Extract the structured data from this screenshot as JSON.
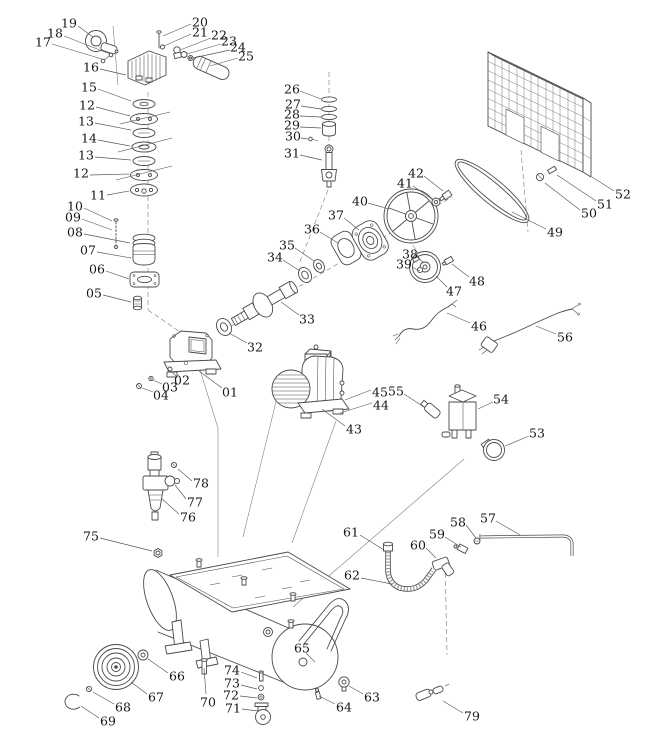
{
  "diagram": {
    "name": "air-compressor-exploded-parts-diagram",
    "background_color": "#ffffff",
    "line_color": "#4a4a4a",
    "label_color": "#161616",
    "part_labels": [
      {
        "text": "19",
        "x": 69,
        "y": 23,
        "line": [
          78,
          26,
          93,
          37
        ]
      },
      {
        "text": "18",
        "x": 55,
        "y": 33,
        "line": [
          64,
          36,
          110,
          54
        ]
      },
      {
        "text": "17",
        "x": 43,
        "y": 42,
        "line": [
          52,
          44,
          102,
          59
        ]
      },
      {
        "text": "16",
        "x": 91,
        "y": 67,
        "line": [
          100,
          69,
          126,
          75
        ]
      },
      {
        "text": "15",
        "x": 89,
        "y": 87,
        "line": [
          98,
          89,
          131,
          101
        ]
      },
      {
        "text": "12",
        "x": 87,
        "y": 105,
        "line": [
          96,
          107,
          130,
          116
        ]
      },
      {
        "text": "13",
        "x": 86,
        "y": 121,
        "line": [
          95,
          123,
          131,
          130
        ]
      },
      {
        "text": "14",
        "x": 89,
        "y": 138,
        "line": [
          98,
          140,
          130,
          146
        ]
      },
      {
        "text": "13",
        "x": 86,
        "y": 155,
        "line": [
          95,
          157,
          131,
          160
        ]
      },
      {
        "text": "12",
        "x": 81,
        "y": 173,
        "line": [
          90,
          175,
          129,
          174
        ]
      },
      {
        "text": "11",
        "x": 98,
        "y": 195,
        "line": [
          107,
          195,
          129,
          191
        ]
      },
      {
        "text": "10",
        "x": 75,
        "y": 206,
        "line": [
          84,
          208,
          112,
          221
        ]
      },
      {
        "text": "09",
        "x": 73,
        "y": 217,
        "line": [
          82,
          219,
          112,
          230
        ]
      },
      {
        "text": "08",
        "x": 75,
        "y": 232,
        "line": [
          84,
          234,
          130,
          243
        ]
      },
      {
        "text": "07",
        "x": 88,
        "y": 250,
        "line": [
          97,
          252,
          131,
          258
        ]
      },
      {
        "text": "06",
        "x": 97,
        "y": 269,
        "line": [
          106,
          271,
          129,
          279
        ]
      },
      {
        "text": "05",
        "x": 94,
        "y": 293,
        "line": [
          103,
          295,
          131,
          302
        ]
      },
      {
        "text": "20",
        "x": 200,
        "y": 22,
        "line": [
          191,
          24,
          163,
          36
        ]
      },
      {
        "text": "21",
        "x": 200,
        "y": 32,
        "line": [
          191,
          34,
          164,
          46
        ]
      },
      {
        "text": "22",
        "x": 219,
        "y": 35,
        "line": [
          211,
          38,
          180,
          50
        ]
      },
      {
        "text": "23",
        "x": 229,
        "y": 41,
        "line": [
          221,
          44,
          187,
          54
        ]
      },
      {
        "text": "24",
        "x": 238,
        "y": 47,
        "line": [
          230,
          50,
          193,
          58
        ]
      },
      {
        "text": "25",
        "x": 246,
        "y": 56,
        "line": [
          238,
          58,
          210,
          66
        ]
      },
      {
        "text": "26",
        "x": 292,
        "y": 89,
        "line": [
          300,
          91,
          321,
          99
        ]
      },
      {
        "text": "27",
        "x": 293,
        "y": 104,
        "line": [
          301,
          106,
          321,
          109
        ]
      },
      {
        "text": "28",
        "x": 292,
        "y": 114,
        "line": [
          300,
          116,
          321,
          117
        ]
      },
      {
        "text": "29",
        "x": 292,
        "y": 125,
        "line": [
          300,
          127,
          321,
          128
        ]
      },
      {
        "text": "30",
        "x": 293,
        "y": 136,
        "line": [
          301,
          138,
          308,
          139
        ]
      },
      {
        "text": "31",
        "x": 292,
        "y": 153,
        "line": [
          300,
          155,
          322,
          160
        ]
      },
      {
        "text": "42",
        "x": 416,
        "y": 173,
        "line": [
          424,
          176,
          443,
          191
        ]
      },
      {
        "text": "41",
        "x": 405,
        "y": 183,
        "line": [
          413,
          186,
          432,
          199
        ]
      },
      {
        "text": "40",
        "x": 360,
        "y": 201,
        "line": [
          368,
          203,
          389,
          209
        ]
      },
      {
        "text": "37",
        "x": 336,
        "y": 215,
        "line": [
          344,
          218,
          359,
          230
        ]
      },
      {
        "text": "36",
        "x": 312,
        "y": 229,
        "line": [
          320,
          232,
          338,
          243
        ]
      },
      {
        "text": "35",
        "x": 287,
        "y": 245,
        "line": [
          295,
          248,
          314,
          261
        ]
      },
      {
        "text": "34",
        "x": 275,
        "y": 257,
        "line": [
          283,
          260,
          300,
          271
        ]
      },
      {
        "text": "38",
        "x": 410,
        "y": 254,
        "line": [
          417,
          257,
          423,
          262
        ]
      },
      {
        "text": "39",
        "x": 404,
        "y": 264,
        "line": [
          412,
          267,
          420,
          271
        ]
      },
      {
        "text": "33",
        "x": 307,
        "y": 319,
        "line": [
          299,
          315,
          281,
          302
        ]
      },
      {
        "text": "32",
        "x": 255,
        "y": 347,
        "line": [
          247,
          343,
          229,
          333
        ]
      },
      {
        "text": "52",
        "x": 623,
        "y": 194,
        "line": [
          614,
          191,
          592,
          177
        ]
      },
      {
        "text": "51",
        "x": 605,
        "y": 204,
        "line": [
          596,
          201,
          557,
          175
        ]
      },
      {
        "text": "50",
        "x": 589,
        "y": 213,
        "line": [
          580,
          210,
          545,
          183
        ]
      },
      {
        "text": "49",
        "x": 555,
        "y": 232,
        "line": [
          546,
          229,
          512,
          212
        ]
      },
      {
        "text": "48",
        "x": 477,
        "y": 281,
        "line": [
          469,
          277,
          452,
          264
        ]
      },
      {
        "text": "47",
        "x": 454,
        "y": 291,
        "line": [
          447,
          287,
          436,
          276
        ]
      },
      {
        "text": "46",
        "x": 479,
        "y": 326,
        "line": [
          470,
          323,
          447,
          313
        ]
      },
      {
        "text": "56",
        "x": 565,
        "y": 337,
        "line": [
          556,
          334,
          536,
          326
        ]
      },
      {
        "text": "02",
        "x": 182,
        "y": 380,
        "line": [
          176,
          376,
          171,
          371
        ]
      },
      {
        "text": "03",
        "x": 170,
        "y": 387,
        "line": [
          162,
          384,
          153,
          380
        ]
      },
      {
        "text": "04",
        "x": 161,
        "y": 395,
        "line": [
          153,
          392,
          142,
          388
        ]
      },
      {
        "text": "01",
        "x": 230,
        "y": 392,
        "line": [
          222,
          388,
          199,
          371
        ]
      },
      {
        "text": "45",
        "x": 380,
        "y": 392,
        "line": [
          371,
          390,
          345,
          400
        ]
      },
      {
        "text": "55",
        "x": 396,
        "y": 391,
        "line": [
          404,
          394,
          424,
          407
        ]
      },
      {
        "text": "44",
        "x": 381,
        "y": 405,
        "line": [
          372,
          403,
          340,
          413
        ]
      },
      {
        "text": "43",
        "x": 354,
        "y": 429,
        "line": [
          345,
          426,
          322,
          409
        ]
      },
      {
        "text": "54",
        "x": 501,
        "y": 399,
        "line": [
          493,
          402,
          478,
          409
        ]
      },
      {
        "text": "53",
        "x": 537,
        "y": 433,
        "line": [
          529,
          436,
          505,
          446
        ]
      },
      {
        "text": "78",
        "x": 201,
        "y": 483,
        "line": [
          192,
          481,
          178,
          469
        ]
      },
      {
        "text": "77",
        "x": 195,
        "y": 502,
        "line": [
          186,
          499,
          175,
          485
        ]
      },
      {
        "text": "76",
        "x": 188,
        "y": 517,
        "line": [
          179,
          514,
          162,
          499
        ]
      },
      {
        "text": "75",
        "x": 91,
        "y": 536,
        "line": [
          100,
          538,
          152,
          551
        ]
      },
      {
        "text": "61",
        "x": 351,
        "y": 532,
        "line": [
          360,
          535,
          384,
          550
        ]
      },
      {
        "text": "57",
        "x": 488,
        "y": 518,
        "line": [
          496,
          521,
          520,
          535
        ]
      },
      {
        "text": "58",
        "x": 458,
        "y": 522,
        "line": [
          466,
          525,
          476,
          538
        ]
      },
      {
        "text": "59",
        "x": 437,
        "y": 534,
        "line": [
          445,
          537,
          461,
          547
        ]
      },
      {
        "text": "60",
        "x": 418,
        "y": 545,
        "line": [
          426,
          548,
          436,
          558
        ]
      },
      {
        "text": "62",
        "x": 352,
        "y": 575,
        "line": [
          361,
          578,
          392,
          584
        ]
      },
      {
        "text": "66",
        "x": 177,
        "y": 676,
        "line": [
          168,
          673,
          148,
          659
        ]
      },
      {
        "text": "67",
        "x": 156,
        "y": 697,
        "line": [
          147,
          694,
          131,
          682
        ]
      },
      {
        "text": "68",
        "x": 123,
        "y": 707,
        "line": [
          114,
          704,
          93,
          692
        ]
      },
      {
        "text": "69",
        "x": 108,
        "y": 721,
        "line": [
          99,
          718,
          81,
          706
        ]
      },
      {
        "text": "70",
        "x": 208,
        "y": 702,
        "line": [
          206,
          694,
          204,
          668
        ]
      },
      {
        "text": "74",
        "x": 232,
        "y": 670,
        "line": [
          241,
          672,
          257,
          678
        ]
      },
      {
        "text": "73",
        "x": 232,
        "y": 683,
        "line": [
          241,
          685,
          257,
          689
        ]
      },
      {
        "text": "72",
        "x": 231,
        "y": 695,
        "line": [
          240,
          696,
          257,
          698
        ]
      },
      {
        "text": "71",
        "x": 233,
        "y": 708,
        "line": [
          242,
          709,
          258,
          711
        ]
      },
      {
        "text": "65",
        "x": 302,
        "y": 648,
        "line": [
          306,
          653,
          315,
          662
        ]
      },
      {
        "text": "64",
        "x": 344,
        "y": 707,
        "line": [
          335,
          704,
          319,
          696
        ]
      },
      {
        "text": "63",
        "x": 372,
        "y": 697,
        "line": [
          363,
          694,
          349,
          686
        ]
      },
      {
        "text": "79",
        "x": 472,
        "y": 716,
        "line": [
          463,
          713,
          443,
          701
        ]
      }
    ]
  }
}
